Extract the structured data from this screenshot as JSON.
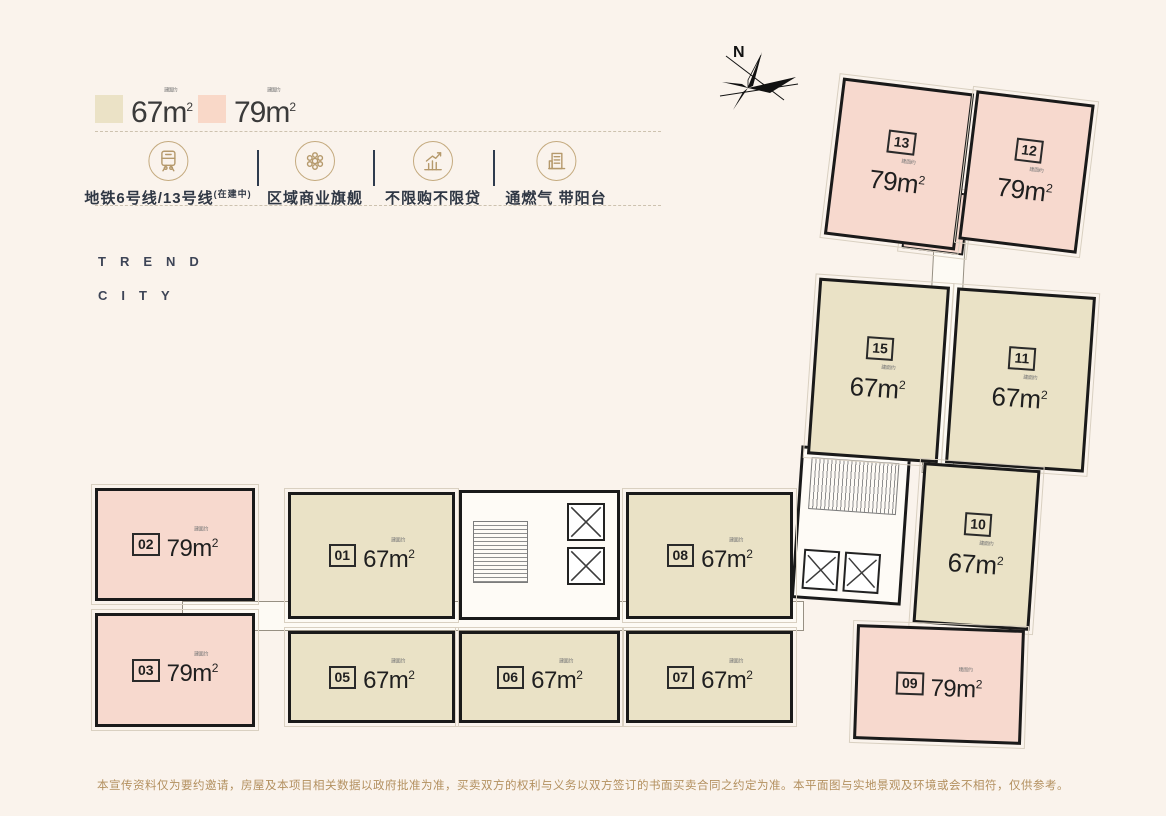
{
  "legend": {
    "area_note": "建面约",
    "items": [
      {
        "area": "67",
        "unit": "m",
        "sup": "2",
        "color": "#EBE2C6"
      },
      {
        "area": "79",
        "unit": "m",
        "sup": "2",
        "color": "#F9D8C8"
      }
    ]
  },
  "features": {
    "items": [
      {
        "icon": "metro-icon",
        "label": "地铁6号线/13号线",
        "suffix": "(在建中)"
      },
      {
        "icon": "mall-icon",
        "label": "区域商业旗舰",
        "suffix": ""
      },
      {
        "icon": "chart-icon",
        "label": "不限购不限贷",
        "suffix": ""
      },
      {
        "icon": "gas-balcony-icon",
        "label": "通燃气 带阳台",
        "suffix": ""
      }
    ]
  },
  "brand": {
    "line1": "TREND",
    "line2": "CITY"
  },
  "compass": {
    "label": "N"
  },
  "plan": {
    "area_note": "建面约",
    "unit": "m",
    "sup": "2",
    "units": [
      {
        "id": "13",
        "area": "79",
        "type": "pink"
      },
      {
        "id": "12",
        "area": "79",
        "type": "pink"
      },
      {
        "id": "15",
        "area": "67",
        "type": "beige"
      },
      {
        "id": "11",
        "area": "67",
        "type": "beige"
      },
      {
        "id": "10",
        "area": "67",
        "type": "beige"
      },
      {
        "id": "09",
        "area": "79",
        "type": "pink"
      },
      {
        "id": "02",
        "area": "79",
        "type": "pink"
      },
      {
        "id": "03",
        "area": "79",
        "type": "pink"
      },
      {
        "id": "01",
        "area": "67",
        "type": "beige"
      },
      {
        "id": "05",
        "area": "67",
        "type": "beige"
      },
      {
        "id": "06",
        "area": "67",
        "type": "beige"
      },
      {
        "id": "08",
        "area": "67",
        "type": "beige"
      },
      {
        "id": "07",
        "area": "67",
        "type": "beige"
      }
    ]
  },
  "footer": {
    "disclaimer": "本宣传资料仅为要约邀请，房屋及本项目相关数据以政府批准为准，买卖双方的权利与义务以双方签订的书面买卖合同之约定为准。本平面图与实地景观及环境或会不相符，仅供参考。"
  },
  "colors": {
    "background": "#FAF3EC",
    "unit_67": "#EAE2C6",
    "unit_79": "#F7D9CE",
    "wall": "#1A1A1A",
    "gold": "#B5996B",
    "navy": "#2F3744",
    "disclaimer": "#B3905F"
  }
}
